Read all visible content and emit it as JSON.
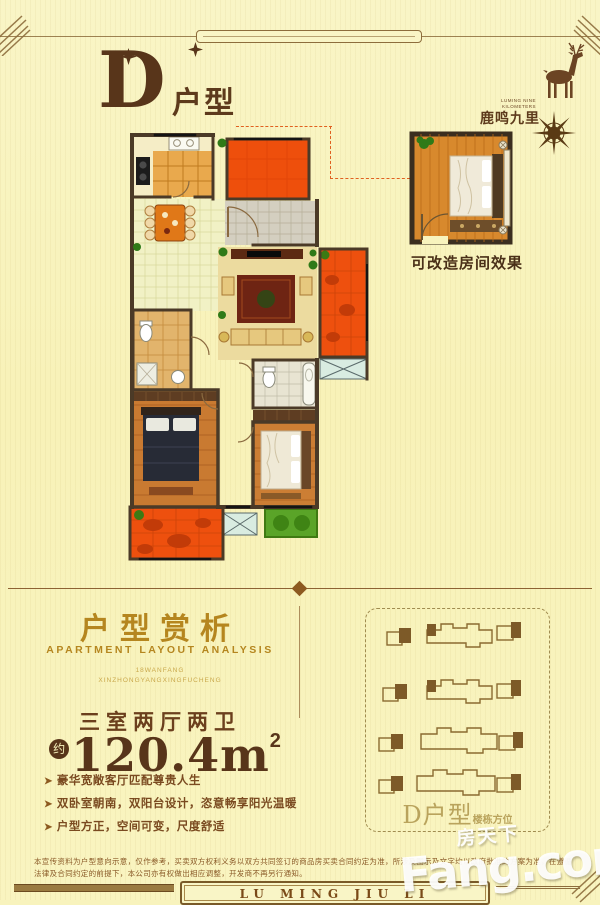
{
  "header": {
    "title_letter": "D",
    "title_suffix": "户型"
  },
  "brand": {
    "name_cn": "鹿鸣九里",
    "name_en": "LUMING NINE KILOMETERS"
  },
  "floor_plan": {
    "convertible_caption": "可改造房间效果"
  },
  "analysis": {
    "title": "户型赏析",
    "subtitle": "APARTMENT LAYOUT ANALYSIS",
    "tagline_line1": "18WANFANG",
    "tagline_line2": "XINZHONGYANGXINGFUCHENG",
    "layout_type": "三室两厅两卫",
    "area_prefix": "约",
    "area_value": "120.4m",
    "area_sup": "2",
    "bullet_icon": "➤",
    "features": [
      "豪华宽敞客厅匹配尊贵人生",
      "双卧室朝南，双阳台设计，恣意畅享阳光温暖",
      "户型方正，空间可变，尺度舒适"
    ]
  },
  "site_plan": {
    "caption_main": "D户型",
    "caption_sub": "楼栋方位"
  },
  "disclaimer": {
    "line1": "本宣传资料为户型意向示意，仅作参考，买卖双方权利义务以双方共同签订的商品房买卖合同约定为准，所涉及图示及文字均以政府批准的方案为准，在遵循",
    "line2": "法律及合同约定的前提下，本公司亦有权做出相应调整，开发商不再另行通知。"
  },
  "footer": {
    "brand_en": "LU MING JIU LI"
  },
  "watermark": {
    "cn": "房天下",
    "en": "Fang.com"
  },
  "colors": {
    "background": "#f8f3bd",
    "accent_red": "#ee4f0c",
    "gold": "#b5861f",
    "brown": "#58351a",
    "green": "#5aa428"
  }
}
